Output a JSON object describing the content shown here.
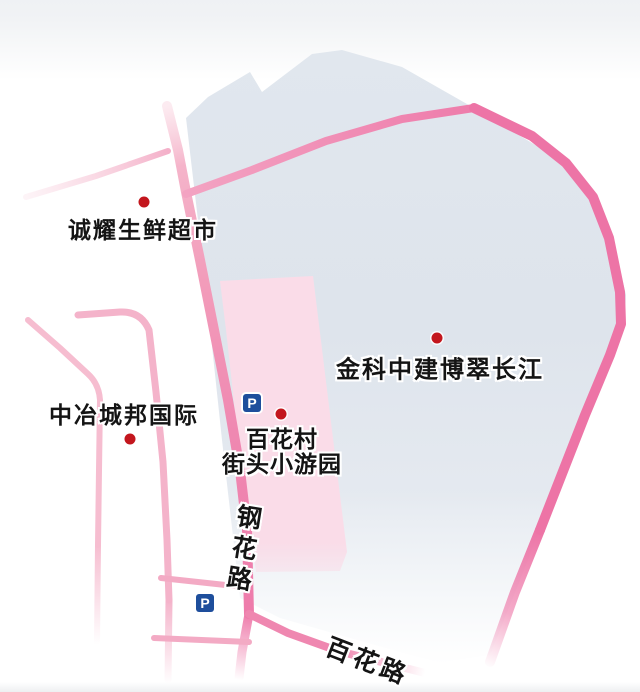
{
  "map": {
    "pois": [
      {
        "name": "诚耀生鲜超市",
        "type": "supermarket"
      },
      {
        "name": "金科中建博翠长江",
        "type": "residential-area"
      },
      {
        "name": "中冶城邦国际",
        "type": "residential-area"
      },
      {
        "line1": "百花村",
        "line2": "街头小游园",
        "type": "street-park"
      }
    ],
    "roads": [
      {
        "name": "钢花路"
      },
      {
        "name": "百花路"
      }
    ],
    "parking_label": "P",
    "colors": {
      "block_fill": "#dee4ec",
      "park_fill": "#fadce8",
      "road_strong": "#ed74a6",
      "road_medium": "#f29ab9",
      "road_light": "#f6bdd0",
      "poi_dot": "#c3161d",
      "parking_blue": "#1e4e9c",
      "label_text": "#141414"
    }
  }
}
